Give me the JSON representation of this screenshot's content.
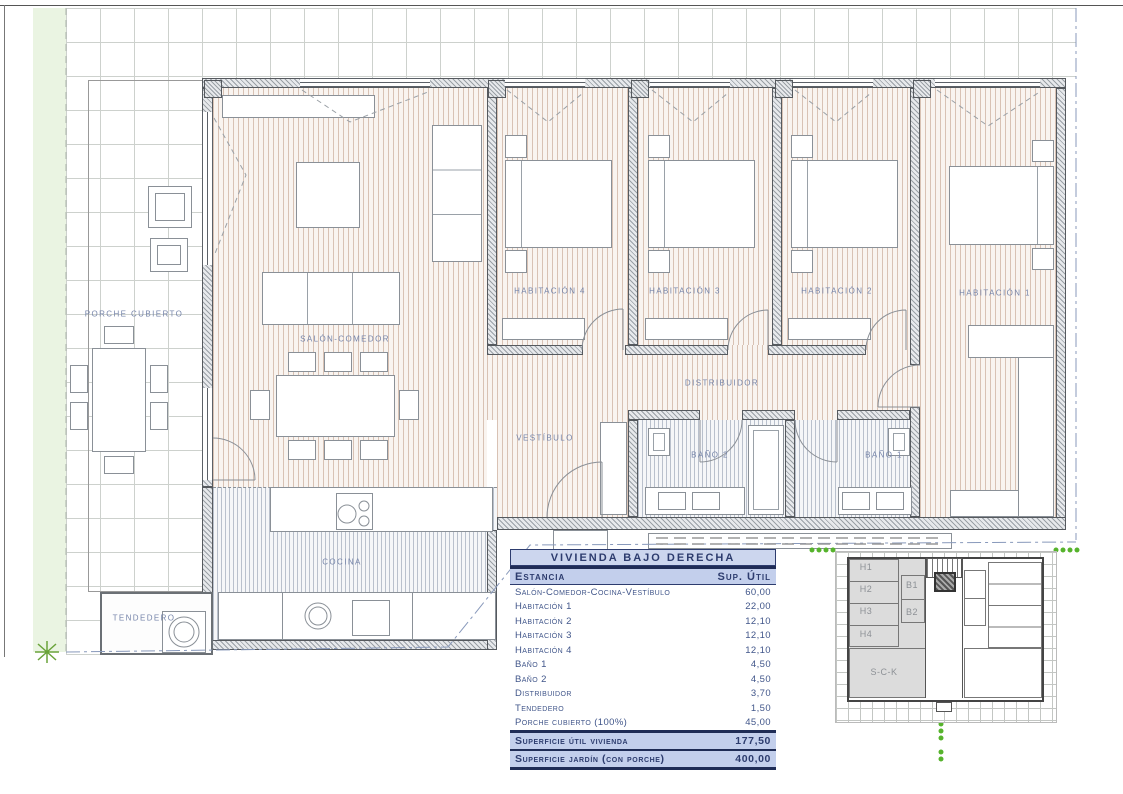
{
  "plan": {
    "rooms": {
      "porche": "PORCHE CUBIERTO",
      "salon": "SALÓN-COMEDOR",
      "cocina": "COCINA",
      "vestibulo": "VESTÍBULO",
      "distribuidor": "DISTRIBUIDOR",
      "habitacion4": "HABITACIÓN 4",
      "habitacion3": "HABITACIÓN 3",
      "habitacion2": "HABITACIÓN 2",
      "habitacion1": "HABITACIÓN 1",
      "bano2": "BAÑO 2",
      "bano1": "BAÑO 1",
      "tendedero": "TENDEDERO"
    }
  },
  "surface_table": {
    "title": "VIVIENDA BAJO DERECHA",
    "columns": {
      "estancia": "Estancia",
      "sup": "Sup. Útil"
    },
    "rows": [
      {
        "name": "Salón-Comedor-Cocina-Vestíbulo",
        "value": "60,00"
      },
      {
        "name": "Habitación 1",
        "value": "22,00"
      },
      {
        "name": "Habitación 2",
        "value": "12,10"
      },
      {
        "name": "Habitación 3",
        "value": "12,10"
      },
      {
        "name": "Habitación 4",
        "value": "12,10"
      },
      {
        "name": "Baño 1",
        "value": "4,50"
      },
      {
        "name": "Baño 2",
        "value": "4,50"
      },
      {
        "name": "Distribuidor",
        "value": "3,70"
      },
      {
        "name": "Tendedero",
        "value": "1,50"
      },
      {
        "name": "Porche cubierto (100%)",
        "value": "45,00"
      }
    ],
    "totals": [
      {
        "name": "Superficie útil vivienda",
        "value": "177,50"
      },
      {
        "name": "Superficie jardín (con porche)",
        "value": "400,00"
      }
    ]
  },
  "key_plan": {
    "rooms": {
      "h1": "H1",
      "h2": "H2",
      "h3": "H3",
      "h4": "H4",
      "b1": "B1",
      "b2": "B2",
      "sck": "S-C-K"
    }
  },
  "colors": {
    "accent_navy": "#2d3c6e",
    "table_fill": "#c3cfec",
    "label_blue": "#7685aa",
    "garden_green": "#eaf4e2",
    "dot_green": "#56b32c",
    "floor_tan": "#be9882",
    "wall_gray": "#9aa0a6",
    "highlight_gray": "#dcdcdc"
  }
}
